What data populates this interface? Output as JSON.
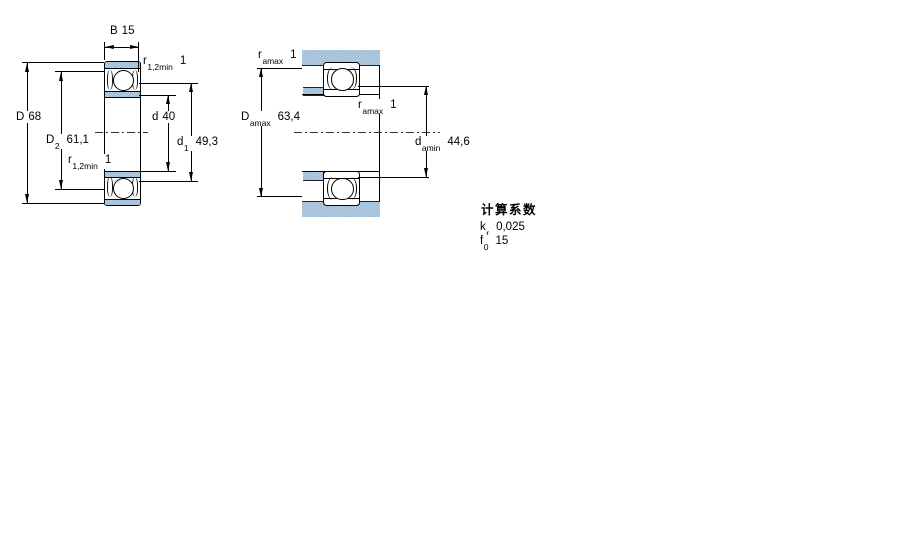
{
  "colors": {
    "steel_blue": "#a6c2da",
    "line": "#000000"
  },
  "left_view": {
    "B": {
      "symbol": "B",
      "value": "15"
    },
    "D": {
      "symbol": "D",
      "value": "68"
    },
    "D2": {
      "symbol": "D",
      "sub": "2",
      "value": "61,1"
    },
    "d": {
      "symbol": "d",
      "value": "40"
    },
    "d1": {
      "symbol": "d",
      "sub": "1",
      "value": "49,3"
    },
    "r12_top": {
      "symbol": "r",
      "sub": "1,2min",
      "value": "1"
    },
    "r12_bottom": {
      "symbol": "r",
      "sub": "1,2min",
      "value": "1"
    }
  },
  "right_view": {
    "r_amax_top": {
      "symbol": "r",
      "sub": "amax",
      "value": "1"
    },
    "r_amax_mid": {
      "symbol": "r",
      "sub": "amax",
      "value": "1"
    },
    "D_amax": {
      "symbol": "D",
      "sub": "amax",
      "value": "63,4"
    },
    "d_amin": {
      "symbol": "d",
      "sub": "amin",
      "value": "44,6"
    }
  },
  "calc_factors": {
    "heading": "计算系数",
    "kr": {
      "symbol": "k",
      "sub": "r",
      "value": "0,025"
    },
    "f0": {
      "symbol": "f",
      "sub": "0",
      "value": "15"
    }
  }
}
